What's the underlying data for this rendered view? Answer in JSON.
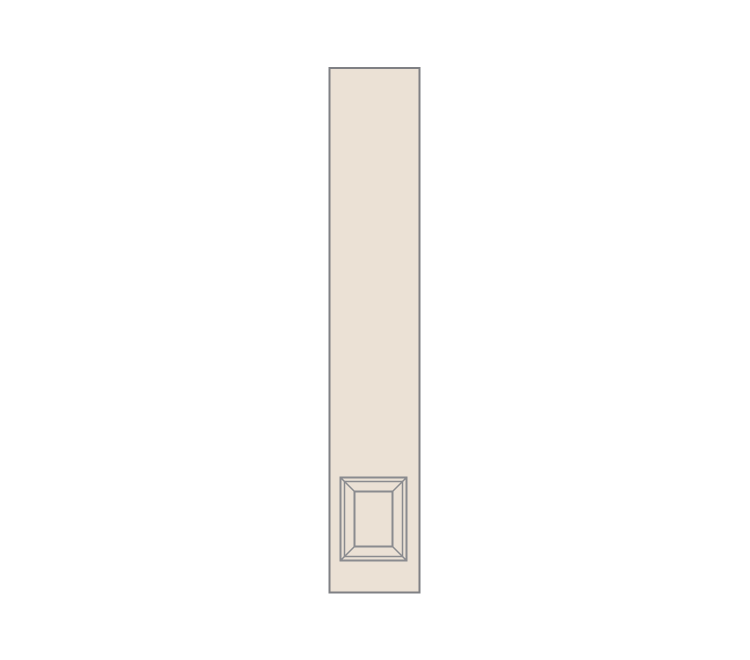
{
  "page": {
    "background_color": "#ffffff"
  },
  "illustration": {
    "name": "tall-cabinet-pilaster-with-raised-panel",
    "colors": {
      "panel_fill": "#ebe1d5",
      "panel_border": "#7f8084",
      "molding_line": "#8a8b8f"
    }
  }
}
